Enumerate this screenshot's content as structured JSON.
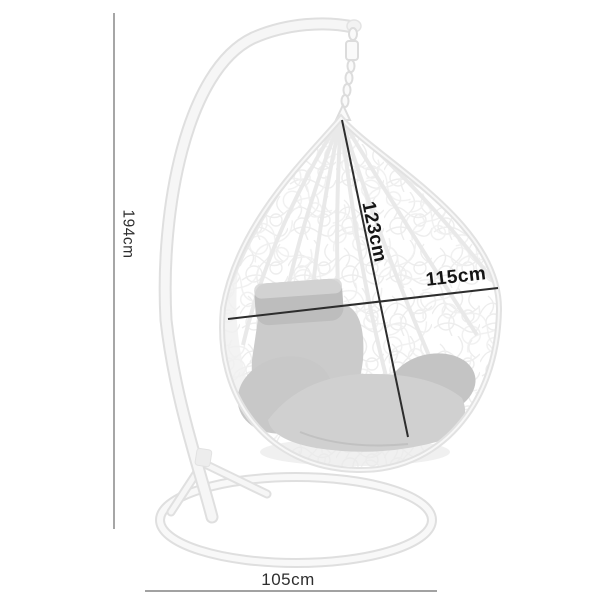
{
  "page": {
    "background": "#ffffff"
  },
  "product": {
    "description": "white wicker hanging egg chair on stand with grey cushions, annotated with dimensions"
  },
  "dimensions": {
    "total_height": "194cm",
    "basket_height": "123cm",
    "basket_width": "115cm",
    "base_width": "105cm"
  },
  "style": {
    "thin_line": "#6b6b6b",
    "bold_line": "#2d2d2d",
    "thin_label": "#2e2e2e",
    "bold_label": "#141414",
    "stand_fill": "#f6f6f6",
    "stand_edge": "#dfdfdf",
    "rim": "#e2e2e2",
    "rib": "#e9e9e9",
    "chain_edge": "#dcdcdc",
    "chain_fill": "#fafafa",
    "seat_cushion": "#d0d0d0",
    "seat_left_cushion": "#c8c8c8",
    "right_cushion": "#c4c4c4",
    "back_cushion": "#cbcbcb",
    "pillow": "#bdbdbd",
    "pillow_highlight": "#d6d6d6"
  }
}
